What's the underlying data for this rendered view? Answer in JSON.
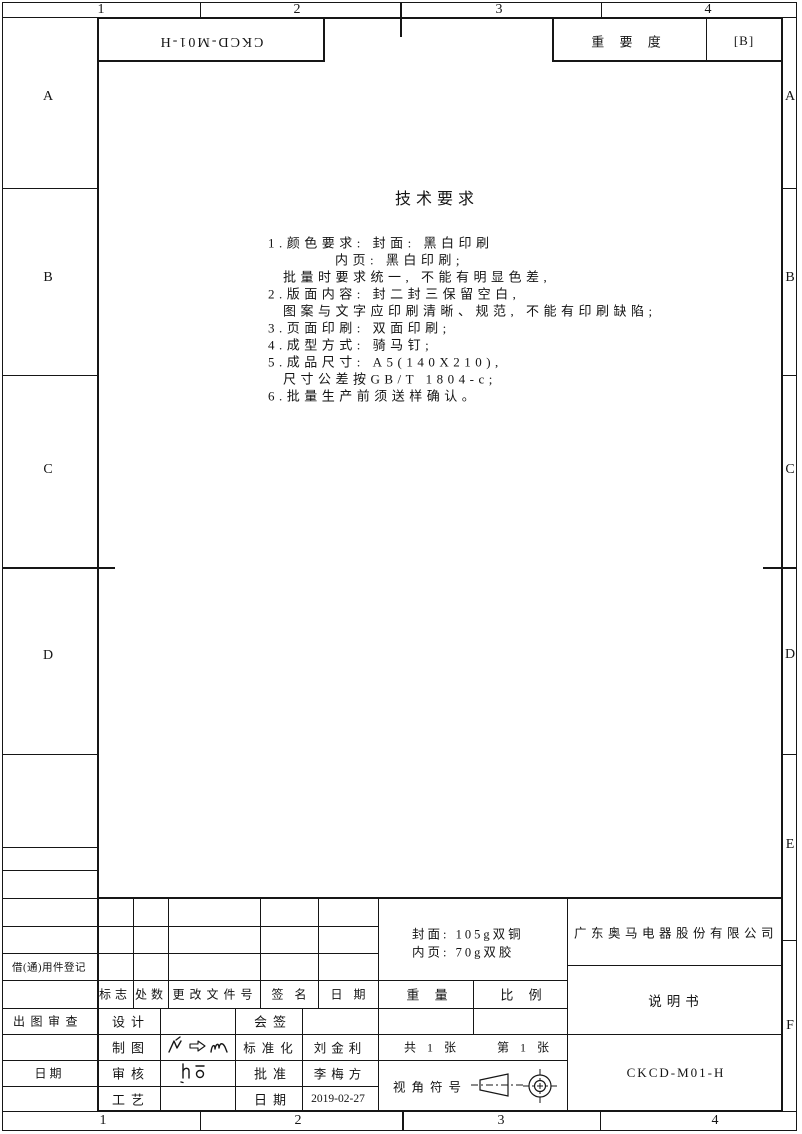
{
  "frame": {
    "zone_cols": [
      "1",
      "2",
      "3",
      "4"
    ],
    "zone_rows_left": [
      "A",
      "B",
      "C",
      "D"
    ],
    "zone_rows_right": [
      "A",
      "B",
      "C",
      "D",
      "E",
      "F"
    ]
  },
  "header": {
    "doc_code_rotated": "CKCD-M01-H",
    "importance_label": "重 要 度",
    "importance_value": "[B]"
  },
  "tech_requirements": {
    "title": "技术要求",
    "lines": [
      "1.颜色要求: 封面: 黑白印刷",
      "内页: 黑白印刷;",
      "批量时要求统一, 不能有明显色差,",
      "2.版面内容: 封二封三保留空白,",
      "图案与文字应印刷清晰、规范, 不能有印刷缺陷;",
      "3.页面印刷: 双面印刷;",
      "4.成型方式: 骑马钉;",
      "5.成品尺寸: A5(140X210),",
      "尺寸公差按GB/T 1804-c;",
      "6.批量生产前须送样确认。"
    ]
  },
  "margin_block": {
    "borrow_label": "借(通)用件登记",
    "plot_review_label": "出图审查",
    "date_label": "日                期"
  },
  "title_block": {
    "revision_header": [
      "标志",
      "处数",
      "更改文件号",
      "签 名",
      "日 期"
    ],
    "approval_rows": [
      {
        "role": "设计",
        "counter": "会签",
        "counter_value": ""
      },
      {
        "role": "制图",
        "counter": "标准化",
        "counter_value": "刘金利"
      },
      {
        "role": "审核",
        "counter": "批准",
        "counter_value": "李梅方"
      },
      {
        "role": "工艺",
        "counter": "日期",
        "counter_value": "2019-02-27"
      }
    ],
    "material_line1": "封面: 105g双铜",
    "material_line2": "内页: 70g双胶",
    "weight_label": "重 量",
    "scale_label": "比 例",
    "sheets_total": "共 1 张",
    "sheet_no": "第 1 张",
    "projection_label": "视角符号",
    "company": "广东奥马电器股份有限公司",
    "doc_title": "说明书",
    "doc_code": "CKCD-M01-H"
  },
  "colors": {
    "ink": "#161616",
    "paper": "#ffffff"
  }
}
